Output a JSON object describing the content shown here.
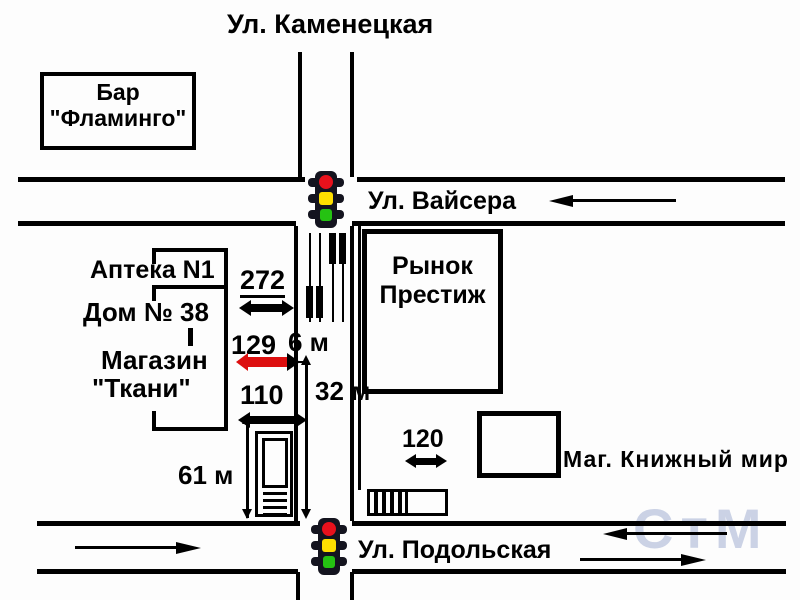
{
  "map": {
    "street_labels": {
      "kamenetskaya": "Ул. Каменецкая",
      "vaysera": "Ул. Вайсера",
      "podolskaya": "Ул. Подольская"
    },
    "buildings": {
      "bar_line1": "Бар",
      "bar_line2": "\"Фламинго\"",
      "apteka": "Аптека N1",
      "dom": "Дом № 38",
      "magazin_line1": "Магазин",
      "magazin_line2": "\"Ткани\"",
      "rynok_line1": "Рынок",
      "rynok_line2": "Престиж",
      "knizhny": "Маг. Книжный мир"
    },
    "measurements": {
      "d272": "272",
      "d129": "129",
      "d6m": "6 м",
      "d110": "110",
      "d32m": "32 м",
      "d61m": "61 м",
      "d120": "120"
    },
    "watermark": "СтМ",
    "colors": {
      "road": "#000000",
      "highlight_arrow": "#dd0f0f",
      "traffic_red": "#e8111c",
      "traffic_yellow": "#ffe000",
      "traffic_green": "#25c212",
      "watermark": "#aab6d6"
    }
  }
}
